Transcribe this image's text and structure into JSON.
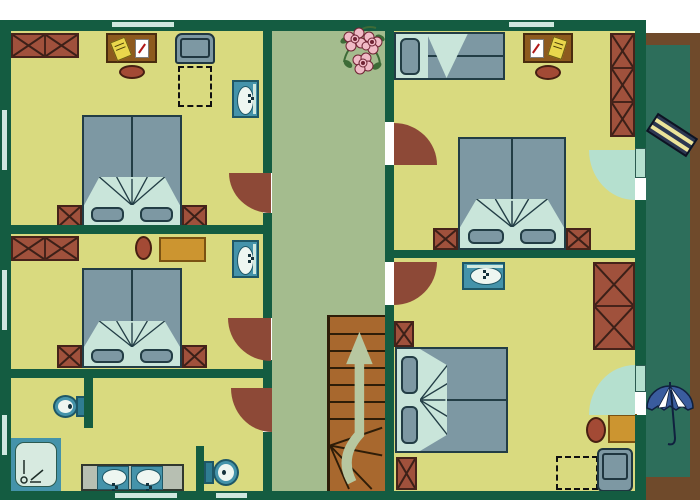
{
  "palette": {
    "wall": "#145c41",
    "floor": "#d9da7f",
    "hallway": "#a4bc8e",
    "balcony": "#2d6e5b",
    "balconyEdge": "#6f4a2b",
    "brick": "#a0513c",
    "brickBorder": "#46231a",
    "brickLine": "#3c2018",
    "duvet": "#7d98a3",
    "bedSheet": "#c9e5da",
    "bedBorder": "#223d45",
    "desk": "#8d5a1e",
    "deskBorder": "#4a2c0e",
    "gold": "#cc9530",
    "goldBorder": "#7a5212",
    "chairRed": "#a34a35",
    "chairBorder": "#471f12",
    "doorArc": "#8d4937",
    "balconyDoor": "#b5e0cf",
    "teal": "#4493aa",
    "tealDark": "#1e5766",
    "fixtureLight": "#eef6f1",
    "counter": "#b7bfb2",
    "showerIn": "#d7eae0",
    "stairs": "#a8682e",
    "stairsLine": "#2e1d08",
    "arrow": "#b7c7a0",
    "loungerBody": "#2c3752",
    "loungerStripe": "#ece49a",
    "umbrellaBlue": "#3a5c9e",
    "flowerPink": "#f0bac6",
    "flowerDark": "#6e2333",
    "leafGreen": "#3d6b37",
    "window": "#cfe8df"
  },
  "rooms": [
    {
      "name": "bedroom-top-left",
      "furniture": [
        "wardrobe",
        "desk",
        "desk-chair",
        "armchair",
        "luggage-area",
        "washbasin",
        "double-bed",
        "nightstand-left",
        "nightstand-right",
        "entry-door"
      ]
    },
    {
      "name": "bedroom-middle-left",
      "furniture": [
        "wardrobe",
        "desk-chair",
        "table",
        "washbasin",
        "double-bed",
        "nightstand-left",
        "nightstand-right",
        "entry-door"
      ]
    },
    {
      "name": "bathroom-bottom-left",
      "furniture": [
        "toilet",
        "toilet",
        "shower",
        "double-vanity",
        "entry-door"
      ]
    },
    {
      "name": "bedroom-top-right",
      "furniture": [
        "single-bed",
        "desk",
        "desk-chair",
        "wardrobe",
        "double-bed",
        "nightstand-left",
        "nightstand-right",
        "entry-door",
        "balcony-door"
      ]
    },
    {
      "name": "bedroom-bottom-right",
      "furniture": [
        "washbasin",
        "wardrobe",
        "double-bed",
        "nightstand-top",
        "nightstand-bottom",
        "side-table",
        "chair",
        "armchair",
        "luggage-area",
        "entry-door",
        "balcony-door"
      ]
    },
    {
      "name": "hallway",
      "furniture": [
        "flower-bouquet",
        "staircase",
        "up-arrow"
      ]
    },
    {
      "name": "balcony",
      "furniture": [
        "sun-lounger",
        "parasol"
      ]
    }
  ]
}
